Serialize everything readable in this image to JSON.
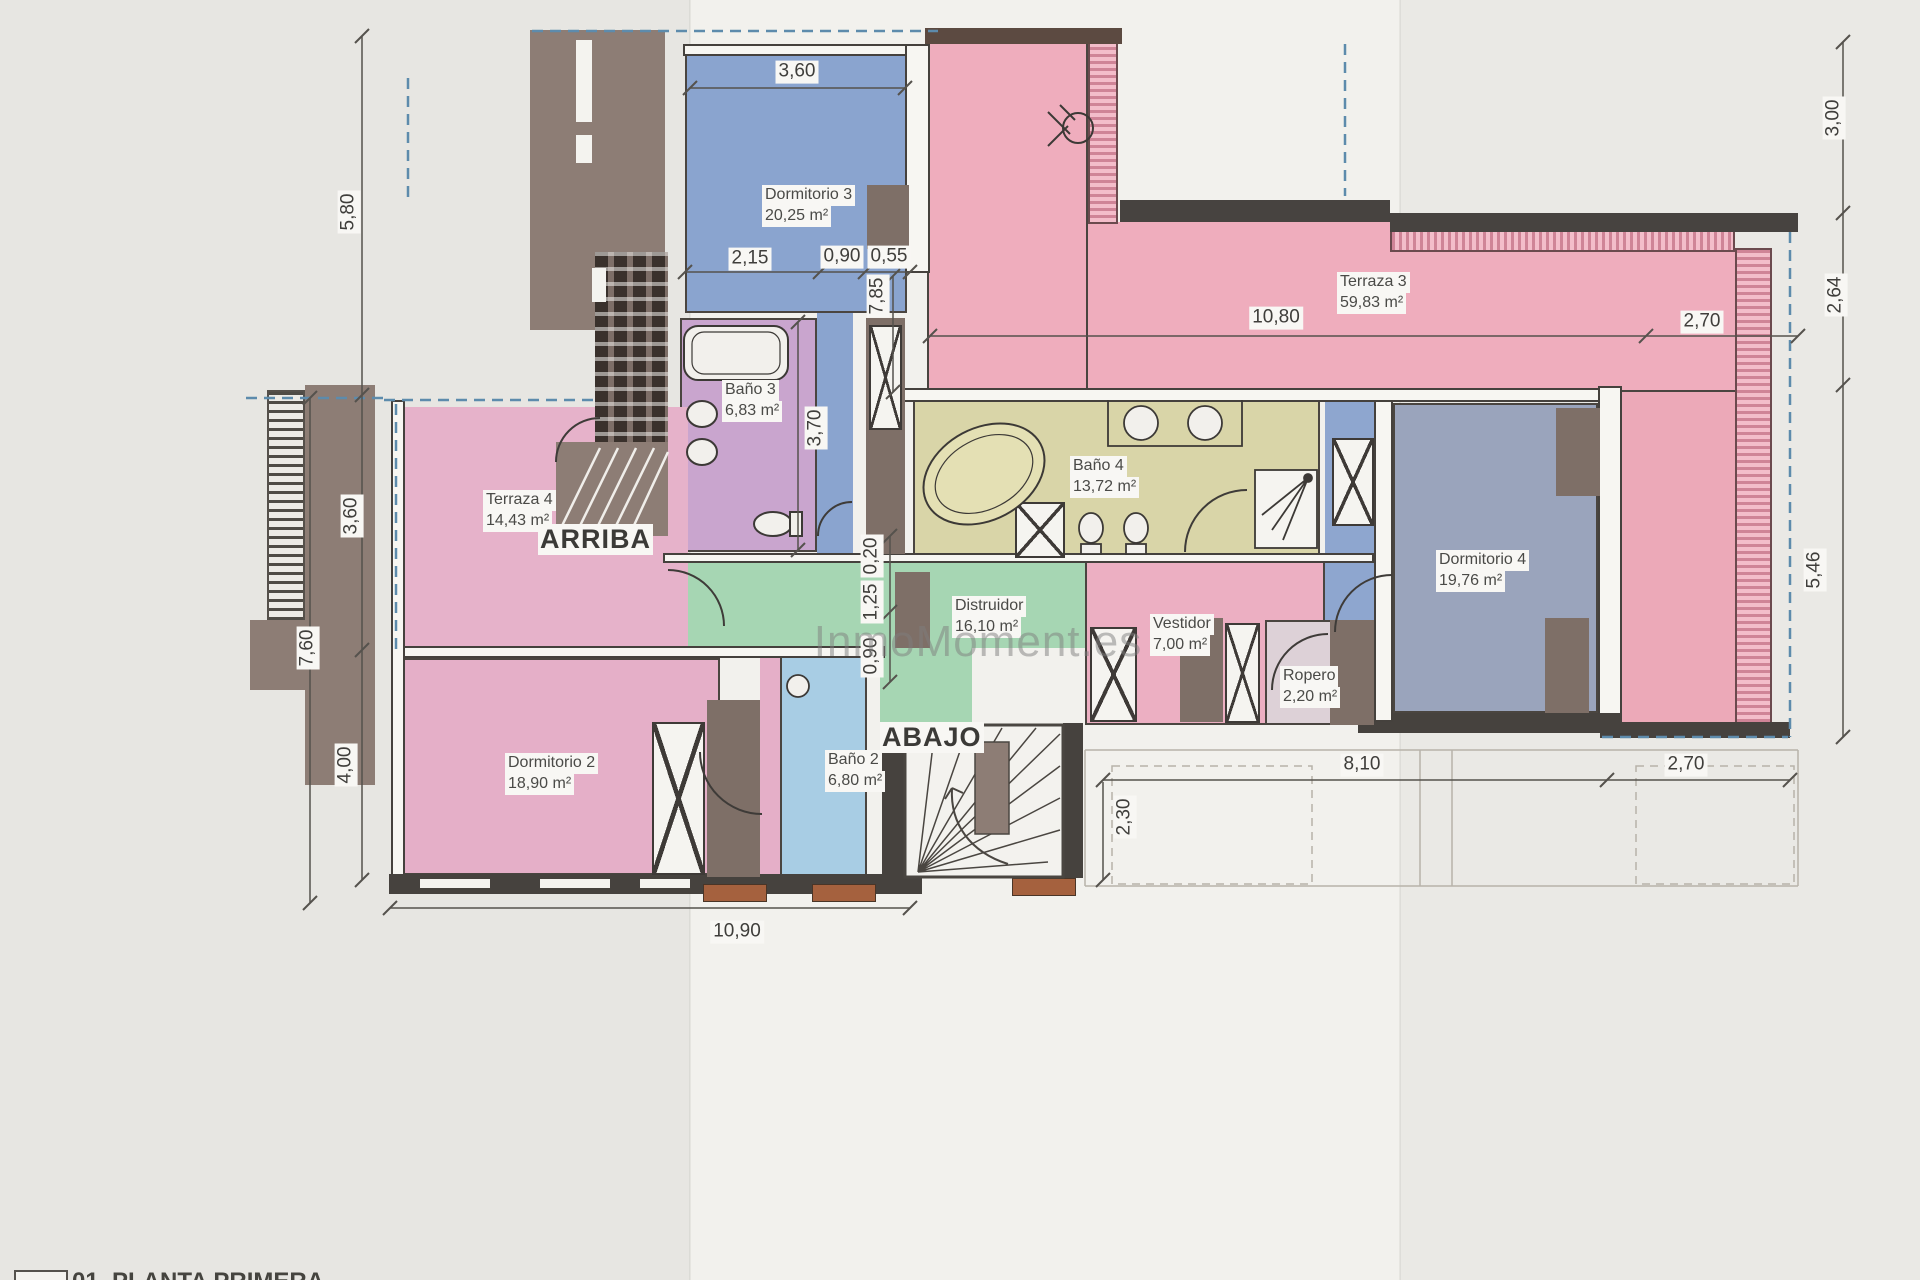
{
  "watermark": "InmoMoment.es",
  "legend": "01. PLANTA PRIMERA",
  "rooms": {
    "dormitorio3": {
      "name": "Dormitorio 3",
      "area": "20,25 m²"
    },
    "terraza3": {
      "name": "Terraza 3",
      "area": "59,83 m²"
    },
    "bano3": {
      "name": "Baño 3",
      "area": "6,83 m²"
    },
    "bano4": {
      "name": "Baño 4",
      "area": "13,72 m²"
    },
    "dormitorio4": {
      "name": "Dormitorio 4",
      "area": "19,76 m²"
    },
    "terraza4": {
      "name": "Terraza 4",
      "area": "14,43 m²"
    },
    "distribuidor": {
      "name": "Distruidor",
      "area": "16,10 m²"
    },
    "vestidor": {
      "name": "Vestidor",
      "area": "7,00 m²"
    },
    "ropero": {
      "name": "Ropero",
      "area": "2,20 m²"
    },
    "dormitorio2": {
      "name": "Dormitorio 2",
      "area": "18,90 m²"
    },
    "bano2": {
      "name": "Baño 2",
      "area": "6,80 m²"
    }
  },
  "stairs": {
    "up": "ARRIBA",
    "down": "ABAJO"
  },
  "dims": {
    "d360top": "3,60",
    "d215": "2,15",
    "d090top": "0,90",
    "d055": "0,55",
    "d785": "7,85",
    "d370": "3,70",
    "d1080": "10,80",
    "d270top": "2,70",
    "d300": "3,00",
    "d264": "2,64",
    "d546": "5,46",
    "d580": "5,80",
    "d360left": "3,60",
    "d760": "7,60",
    "d400": "4,00",
    "d020": "0,20",
    "d125": "1,25",
    "d090mid": "0,90",
    "d1090": "10,90",
    "d810": "8,10",
    "d270bot": "2,70",
    "d230": "2,30"
  },
  "colors": {
    "bedroom_blue": "#8aa4cf",
    "bedroom4_blue": "#9aa4bc",
    "bath2_blue": "#a8cde4",
    "terrace_pink": "#efadbd",
    "terrace4_pink": "#e6b2ca",
    "vestidor_pink": "#ecafc2",
    "bath3_lilac": "#c9a5ce",
    "bath4_khaki": "#d9d5a8",
    "hall_green": "#a6d6b3",
    "wall_dark": "#46423e",
    "wood_brown": "#8d7d75",
    "boundary_blue": "#5d8bac"
  }
}
